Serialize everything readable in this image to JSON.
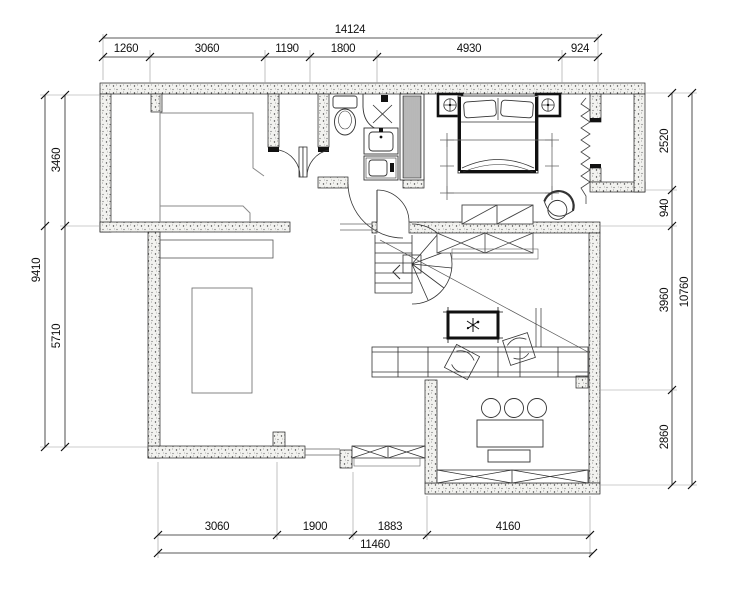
{
  "drawing": {
    "type": "architectural-floor-plan",
    "colors": {
      "background": "#ffffff",
      "line": "#222222",
      "wall_speckle": "#555555"
    }
  },
  "dimensions": {
    "top": {
      "overall": "14124",
      "segments": [
        "1260",
        "3060",
        "1190",
        "1800",
        "4930",
        "924"
      ]
    },
    "bottom": {
      "overall": "11460",
      "segments": [
        "3060",
        "1900",
        "1883",
        "4160"
      ]
    },
    "left": {
      "overall": "9410",
      "segments": [
        "3460",
        "5710"
      ]
    },
    "right": {
      "overall": "10760",
      "segments": [
        "2520",
        "940",
        "3960",
        "2860"
      ]
    }
  }
}
